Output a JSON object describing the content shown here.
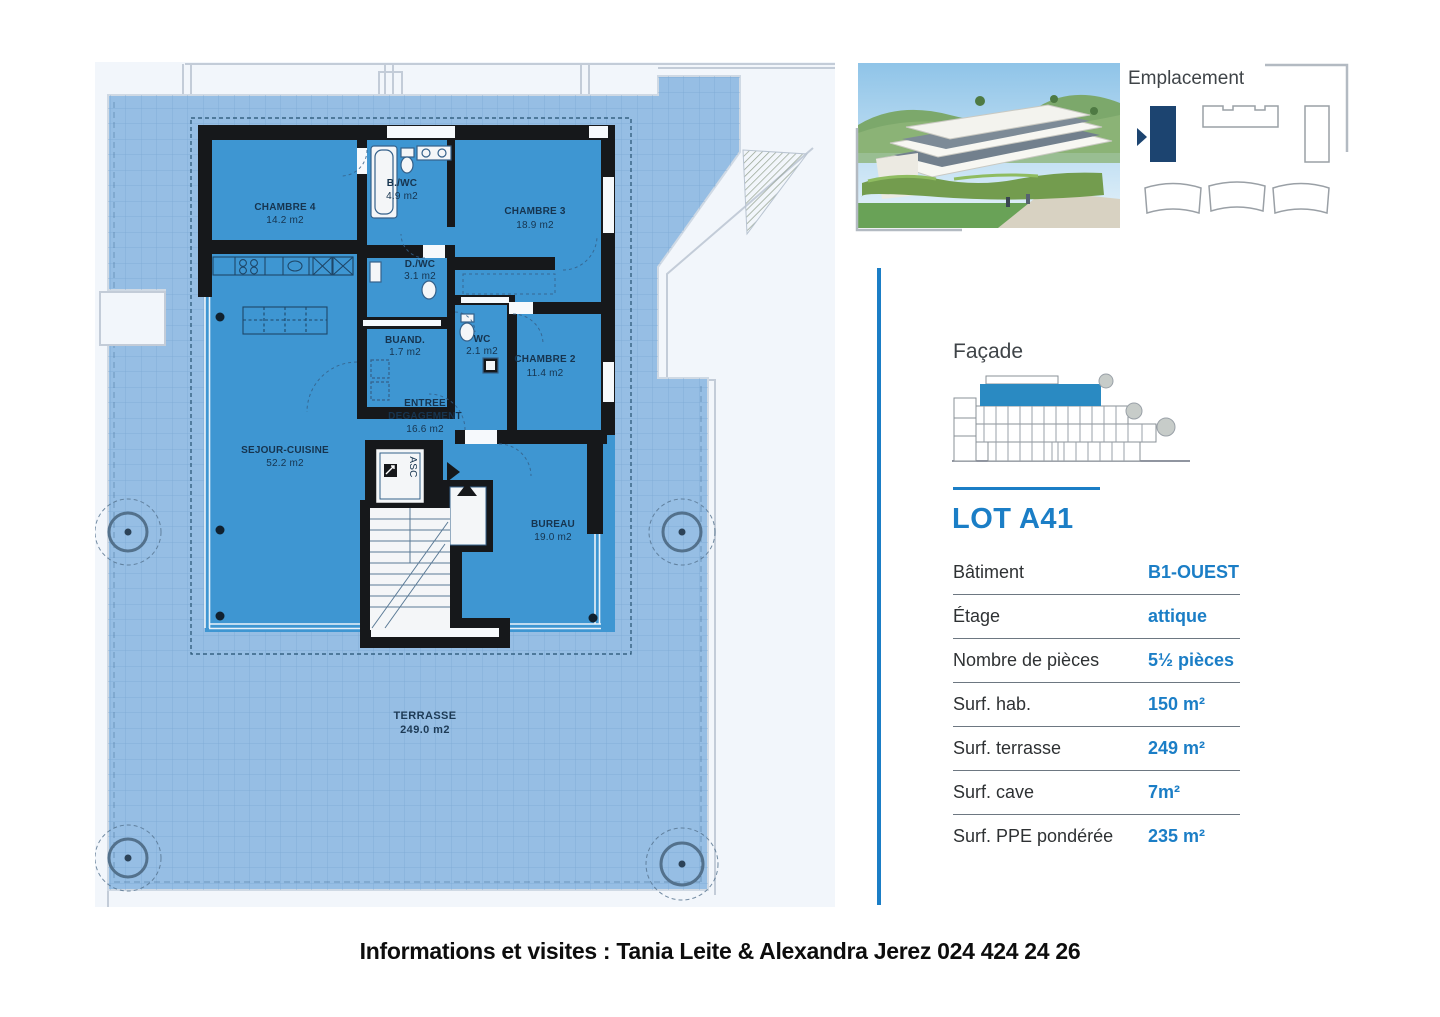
{
  "plan": {
    "rooms": {
      "chambre4": {
        "name": "CHAMBRE 4",
        "area": "14.2 m2"
      },
      "bwc": {
        "name": "B./WC",
        "area": "4.9 m2"
      },
      "chambre3": {
        "name": "CHAMBRE 3",
        "area": "18.9 m2"
      },
      "dwc": {
        "name": "D./WC",
        "area": "3.1 m2"
      },
      "buand": {
        "name": "BUAND.",
        "area": "1.7 m2"
      },
      "wc": {
        "name": "WC",
        "area": "2.1 m2"
      },
      "chambre2": {
        "name": "CHAMBRE 2",
        "area": "11.4 m2"
      },
      "entree": {
        "line1": "ENTREE",
        "line2": "DEGAGEMENT",
        "area": "16.6 m2"
      },
      "sejour": {
        "name": "SEJOUR-CUISINE",
        "area": "52.2 m2"
      },
      "bureau": {
        "name": "BUREAU",
        "area": "19.0 m2"
      },
      "terrasse": {
        "name": "TERRASSE",
        "area": "249.0 m2"
      }
    },
    "elevator_label": "ASC"
  },
  "emplacement": {
    "title": "Emplacement"
  },
  "facade": {
    "title": "Façade"
  },
  "lot": {
    "title": "LOT A41",
    "rows": [
      {
        "label": "Bâtiment",
        "value": "B1-OUEST"
      },
      {
        "label": "Étage",
        "value": "attique"
      },
      {
        "label": "Nombre de pièces",
        "value": "5½ pièces"
      },
      {
        "label": "Surf. hab.",
        "value": "150 m²"
      },
      {
        "label": "Surf. terrasse",
        "value": "249 m²"
      },
      {
        "label": "Surf. cave",
        "value": "7m²"
      },
      {
        "label": "Surf. PPE pondérée",
        "value": "235 m²"
      }
    ]
  },
  "footer": "Informations et visites : Tania Leite & Alexandra Jerez 024 424 24 26",
  "colors": {
    "accent": "#1b7ec6",
    "navy": "#1c4470",
    "apartment_blue": "#3e96d2",
    "terrace_blue": "#96bee4",
    "wall": "#16181b"
  }
}
